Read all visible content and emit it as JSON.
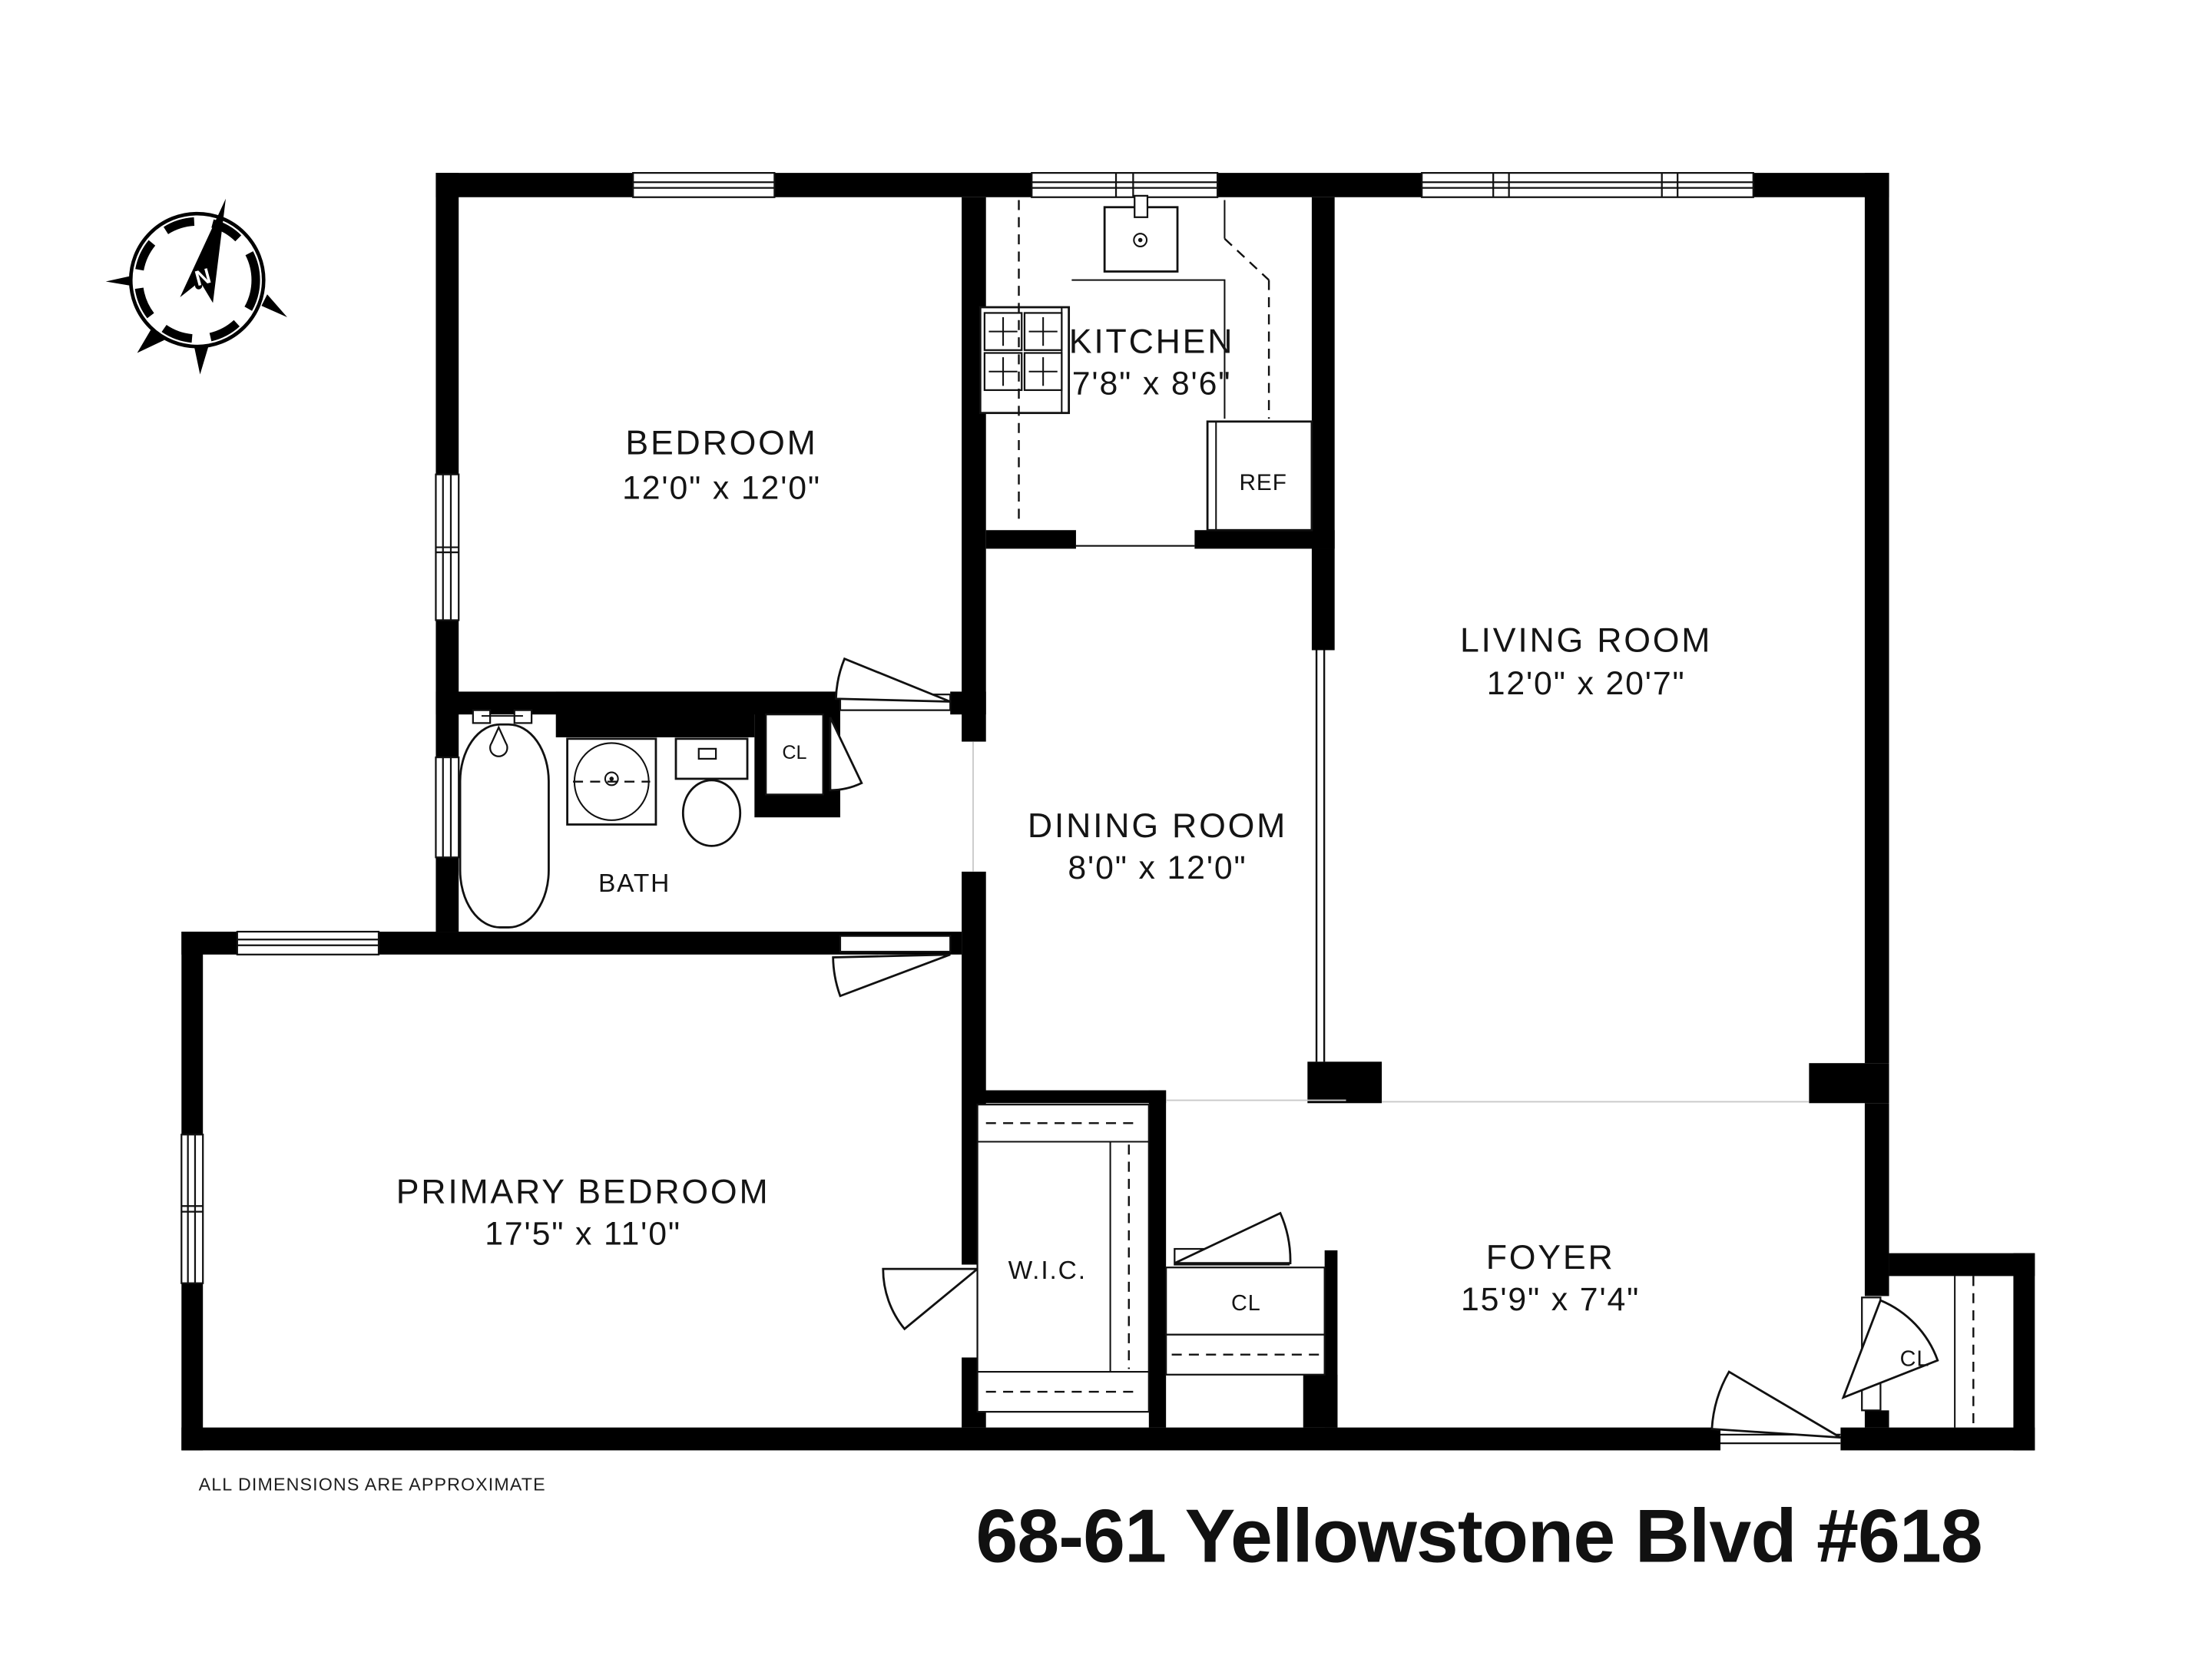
{
  "title": "68-61 Yellowstone Blvd #618",
  "disclaimer": "ALL DIMENSIONS ARE APPROXIMATE",
  "compass": {
    "north_label": "N"
  },
  "rooms": {
    "bedroom": {
      "name": "BEDROOM",
      "dims": "12'0\" x 12'0\""
    },
    "kitchen": {
      "name": "KITCHEN",
      "dims": "7'8\" x 8'6\""
    },
    "living_room": {
      "name": "LIVING ROOM",
      "dims": "12'0\" x 20'7\""
    },
    "dining_room": {
      "name": "DINING ROOM",
      "dims": "8'0\" x 12'0\""
    },
    "primary_bedroom": {
      "name": "PRIMARY BEDROOM",
      "dims": "17'5\" x 11'0\""
    },
    "foyer": {
      "name": "FOYER",
      "dims": "15'9\" x 7'4\""
    },
    "bath": {
      "name": "BATH"
    },
    "walk_in_closet": {
      "name": "W.I.C."
    },
    "closet_bath": {
      "label": "CL"
    },
    "closet_hall": {
      "label": "CL"
    },
    "closet_foyer": {
      "label": "CL"
    }
  },
  "fixtures": {
    "refrigerator": "REF"
  },
  "colors": {
    "wall": "#000000",
    "background": "#ffffff",
    "line": "#111111"
  }
}
